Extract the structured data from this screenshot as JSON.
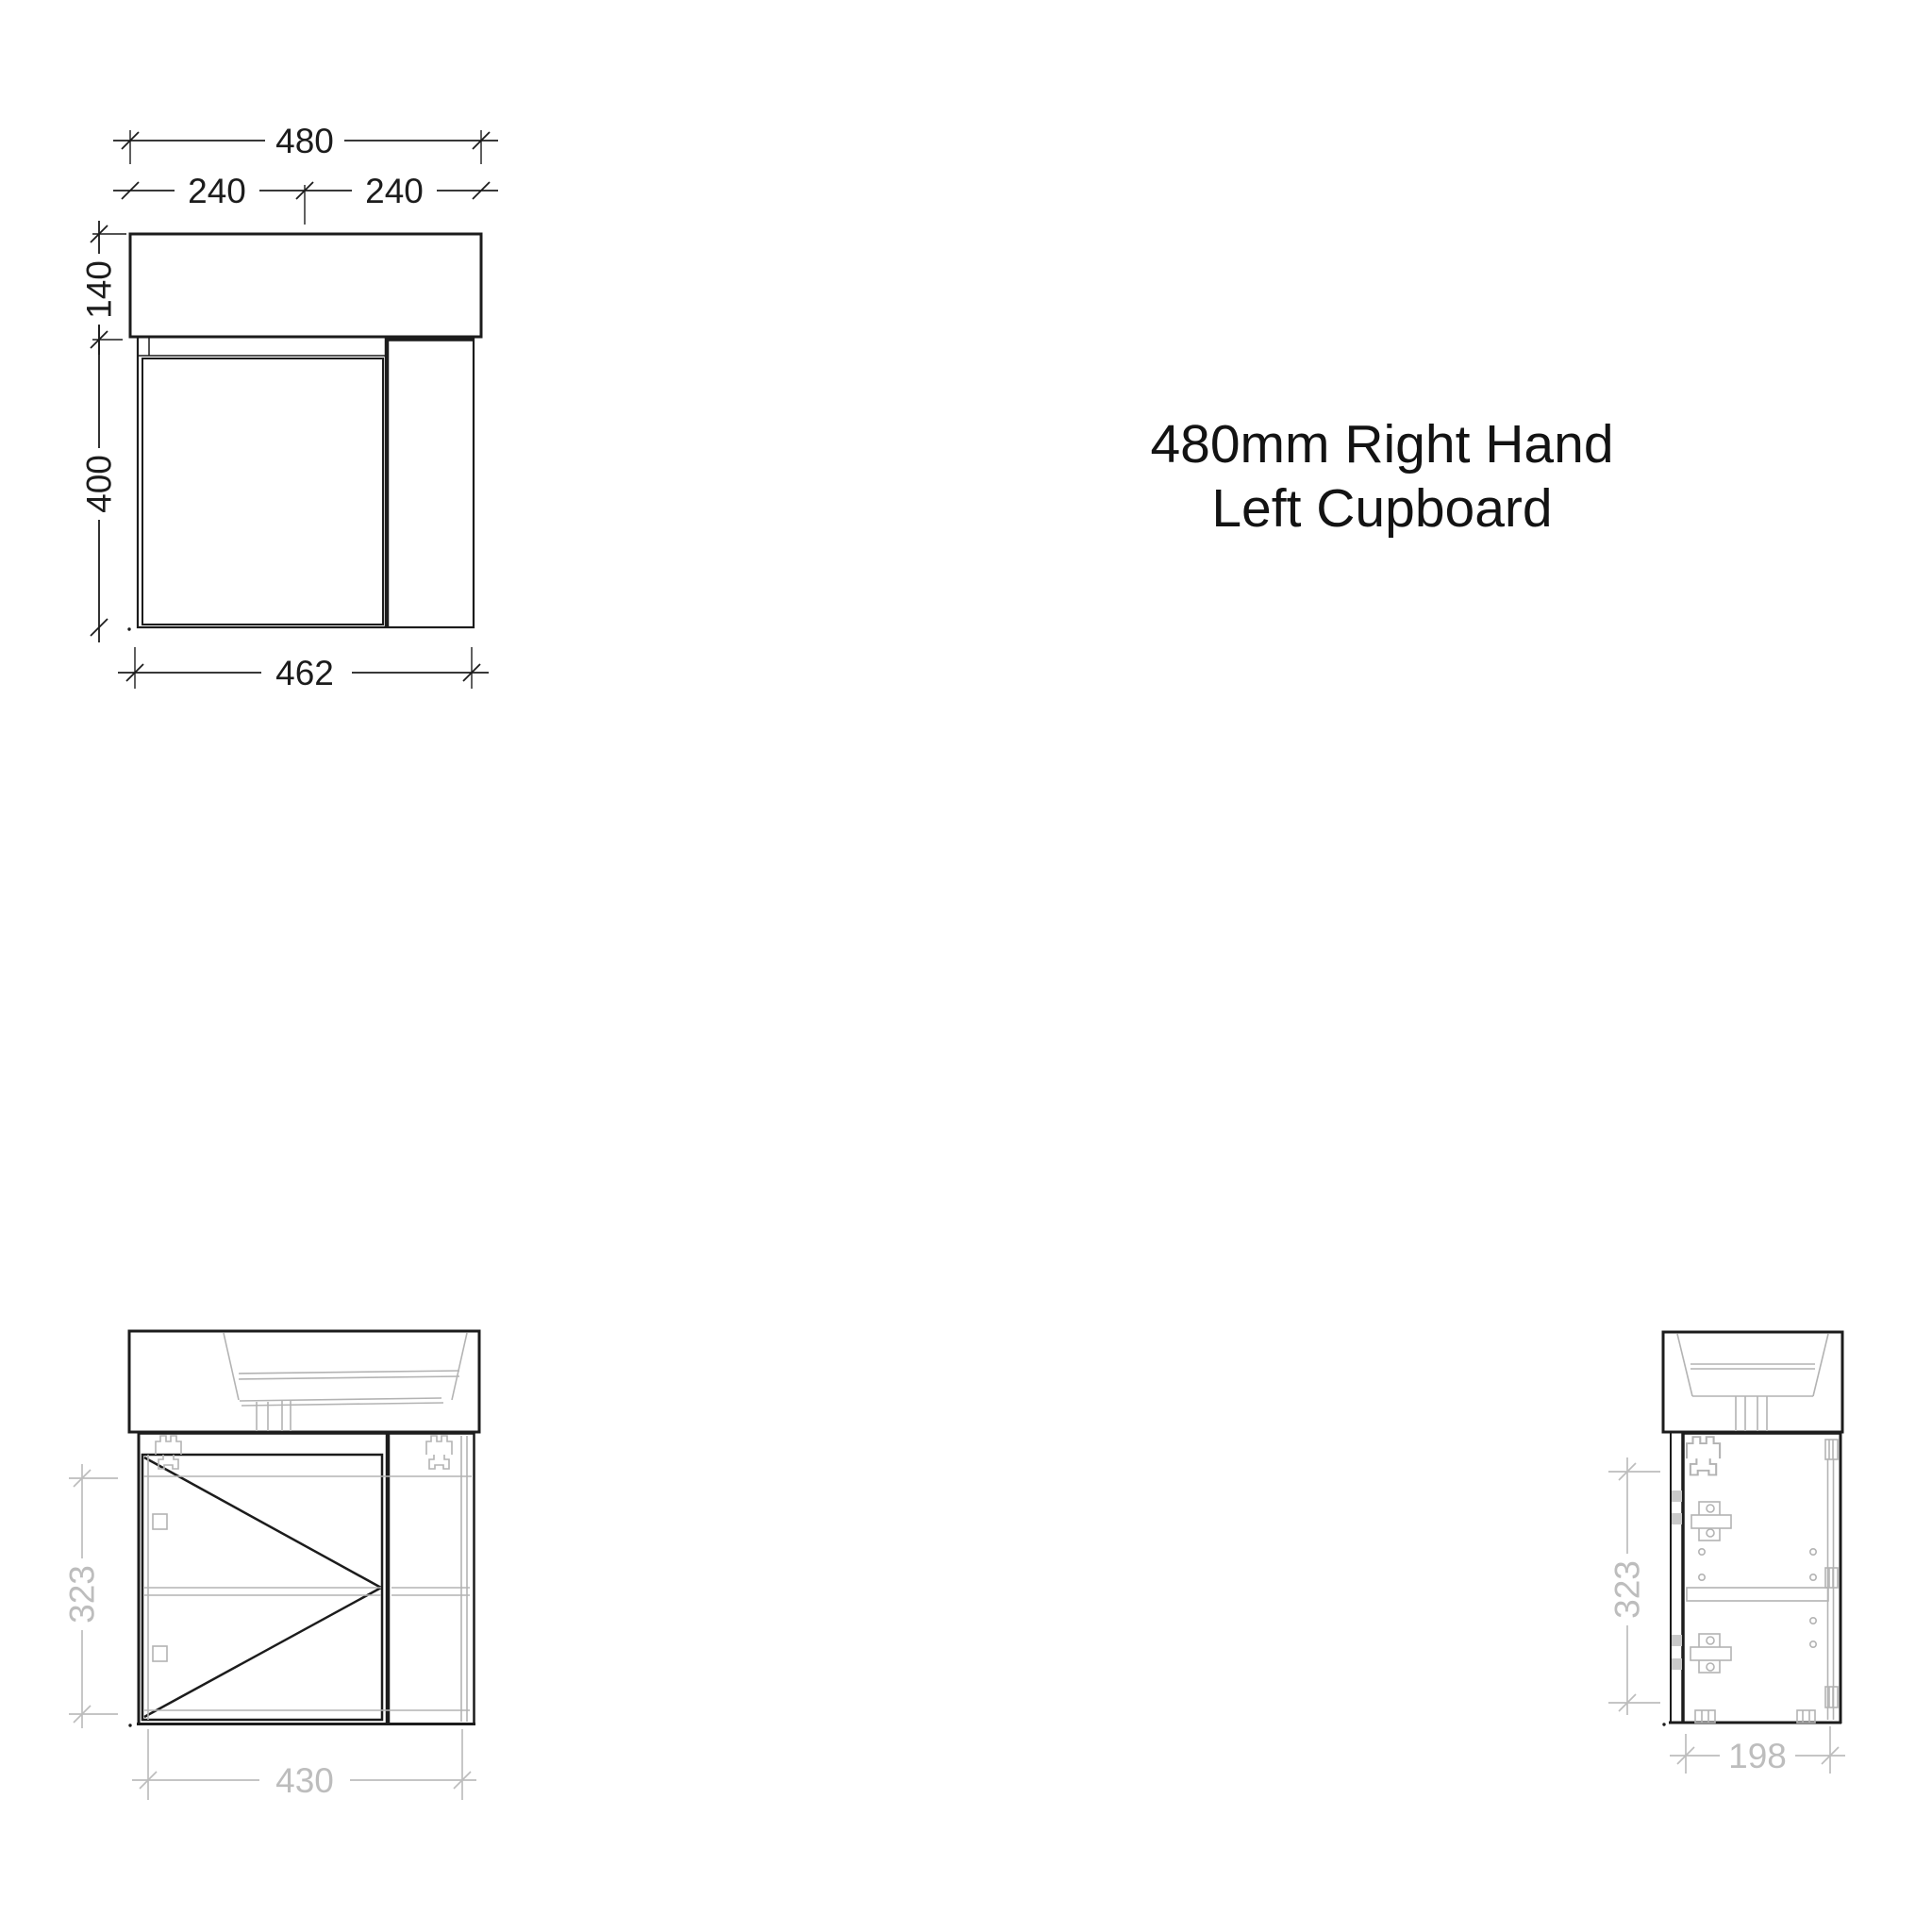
{
  "title": {
    "line1": "480mm Right Hand",
    "line2": "Left Cupboard"
  },
  "colors": {
    "drawing_line": "#1c1c1c",
    "detail_gray": "#b3b3b3",
    "dim_gray": "#bdbdbd",
    "background": "#ffffff",
    "title_text": "#131313"
  },
  "front_elevation": {
    "dims": {
      "total_width": "480",
      "left_width": "240",
      "right_width": "240",
      "top_height": "140",
      "cabinet_height": "400",
      "bottom_width": "462"
    }
  },
  "front_view": {
    "dims": {
      "height": "323",
      "width": "430"
    }
  },
  "side_view": {
    "dims": {
      "height": "323",
      "width": "198"
    }
  }
}
